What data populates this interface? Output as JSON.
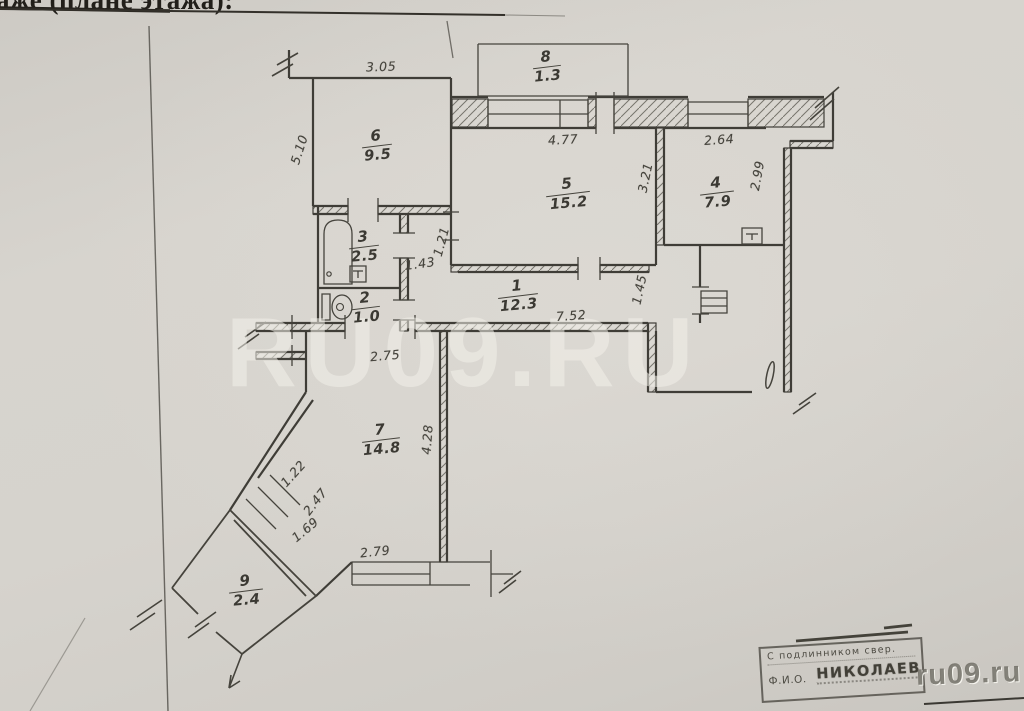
{
  "document": {
    "header": {
      "title_fragment": "аже (плане этажа):"
    },
    "watermark": {
      "large": "RU09.RU",
      "small": "ru09.ru"
    },
    "stamp": {
      "certify_line": "С подлинником свер.",
      "fio_label": "Ф.И.О.",
      "name": "НИКОЛАЕВ"
    },
    "plan": {
      "rooms": [
        {
          "number": "6",
          "area": "9.5"
        },
        {
          "number": "8",
          "area": "1.3"
        },
        {
          "number": "5",
          "area": "15.2"
        },
        {
          "number": "4",
          "area": "7.9"
        },
        {
          "number": "3",
          "area": "2.5"
        },
        {
          "number": "2",
          "area": "1.0"
        },
        {
          "number": "1",
          "area": "12.3"
        },
        {
          "number": "7",
          "area": "14.8"
        },
        {
          "number": "9",
          "area": "2.4"
        }
      ],
      "dimensions": [
        {
          "value": "3.05"
        },
        {
          "value": "5.10"
        },
        {
          "value": "4.77"
        },
        {
          "value": "2.64"
        },
        {
          "value": "2.99"
        },
        {
          "value": "3.21"
        },
        {
          "value": "1.21"
        },
        {
          "value": "1.43"
        },
        {
          "value": "7.52"
        },
        {
          "value": "1.45"
        },
        {
          "value": "2.75"
        },
        {
          "value": "4.28"
        },
        {
          "value": "1.22"
        },
        {
          "value": "2.47"
        },
        {
          "value": "1.69"
        },
        {
          "value": "2.79"
        }
      ]
    }
  }
}
